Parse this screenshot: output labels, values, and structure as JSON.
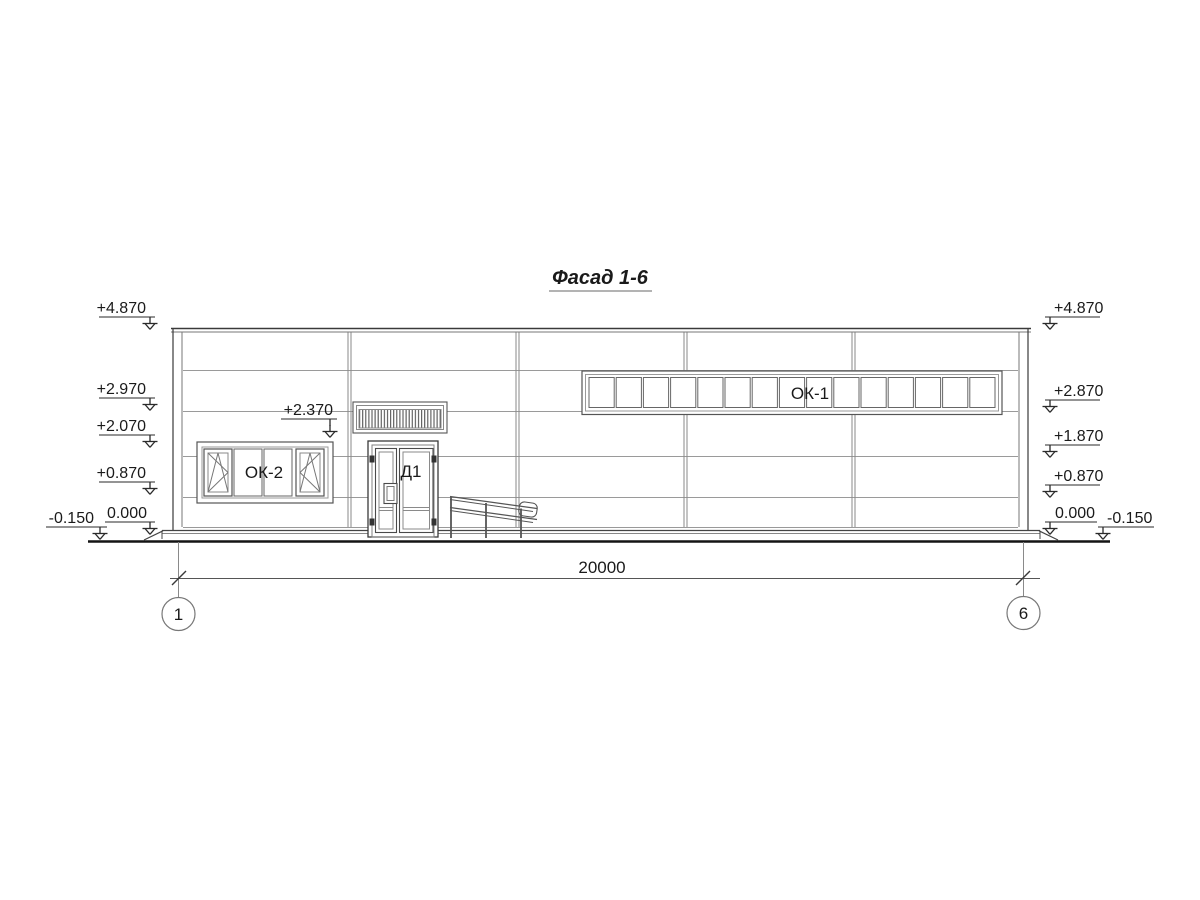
{
  "title": "Фасад 1-6",
  "elevation_marks": {
    "left": [
      "+4.870",
      "+2.970",
      "+2.070",
      "+0.870",
      "0.000",
      "-0.150"
    ],
    "right": [
      "+4.870",
      "+2.870",
      "+1.870",
      "+0.870",
      "0.000",
      "-0.150"
    ],
    "door": "+2.370"
  },
  "labels": {
    "ribbon_window": "ОК-1",
    "window": "ОК-2",
    "door": "Д1"
  },
  "dimension": {
    "overall_width": "20000"
  },
  "axes": {
    "first": "1",
    "last": "6"
  },
  "colors": {
    "line_dark": "#3a3a3a",
    "line_mid": "#6e6e6e",
    "line_light": "#9a9a9a",
    "background": "#ffffff"
  }
}
